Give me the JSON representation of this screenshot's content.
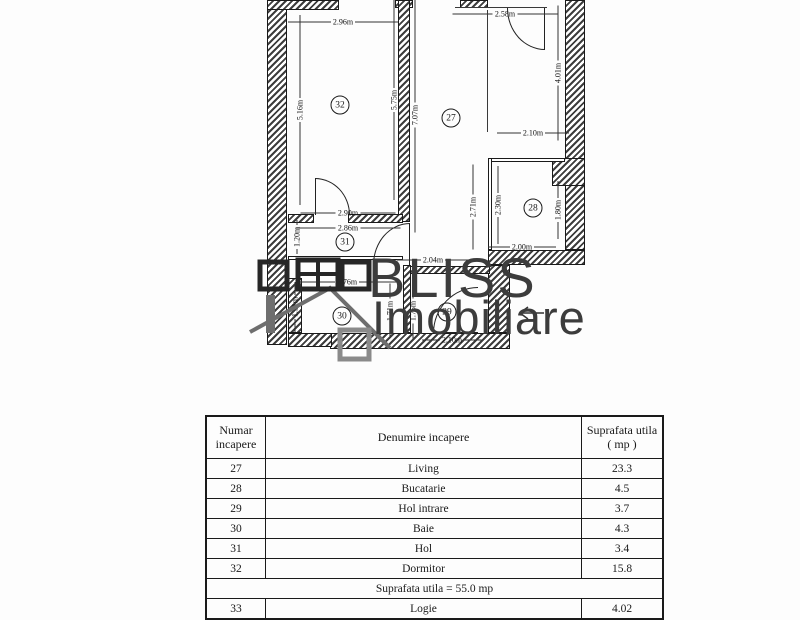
{
  "watermark": {
    "brand": "BLISS",
    "brand2": "Imobiliare"
  },
  "plan": {
    "rooms": {
      "r27": "27",
      "r28": "28",
      "r29": "29",
      "r30": "30",
      "r31": "31",
      "r32": "32"
    },
    "dims": {
      "d296": "2.96m",
      "d258": "2.58m",
      "d516": "5.16m",
      "d575": "5.75m",
      "d707": "7.07m",
      "d401": "4.01m",
      "d210": "2.10m",
      "d271": "2.71m",
      "d230": "2.30m",
      "d180": "1.80m",
      "d200": "2.00m",
      "d290": "2.90m",
      "d286": "2.86m",
      "d120": "1.20m",
      "d276": "2.76m",
      "d151": "1.51m",
      "d204": "2.04m",
      "d171": "1.71m",
      "d175": "1.75m",
      "d210b": "2.10m"
    }
  },
  "table": {
    "header": {
      "col1a": "Numar",
      "col1b": "incapere",
      "col2": "Denumire incapere",
      "col3a": "Suprafata utila",
      "col3b": "( mp )"
    },
    "rows": [
      {
        "num": "27",
        "name": "Living",
        "area": "23.3"
      },
      {
        "num": "28",
        "name": "Bucatarie",
        "area": "4.5"
      },
      {
        "num": "29",
        "name": "Hol intrare",
        "area": "3.7"
      },
      {
        "num": "30",
        "name": "Baie",
        "area": "4.3"
      },
      {
        "num": "31",
        "name": "Hol",
        "area": "3.4"
      },
      {
        "num": "32",
        "name": "Dormitor",
        "area": "15.8"
      }
    ],
    "total": "Suprafata utila = 55.0 mp",
    "extra": {
      "num": "33",
      "name": "Logie",
      "area": "4.02"
    }
  }
}
